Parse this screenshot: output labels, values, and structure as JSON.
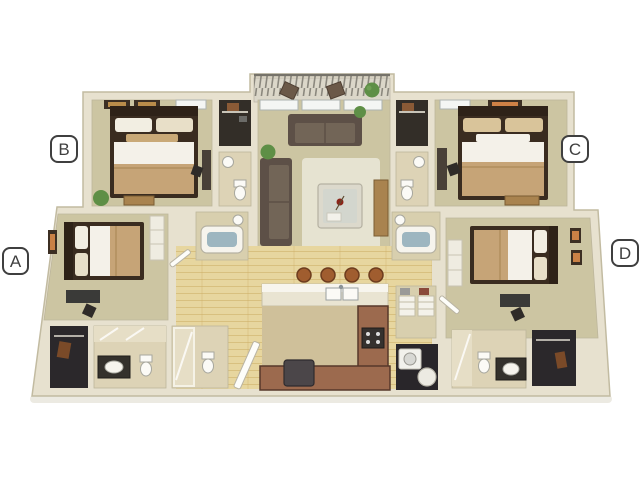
{
  "page": {
    "background_color": "#ffffff"
  },
  "floorplan": {
    "description": "3D rendered top-down floor plan of a four-bedroom, four-bath apartment with central living room, kitchen with breakfast bar, balcony, laundry and closets",
    "labels": {
      "a": "A",
      "b": "B",
      "c": "C",
      "d": "D"
    },
    "colors": {
      "wall_cream": "#e7e1cf",
      "wall_edge": "#c2bba1",
      "bedroom_floor_khaki": "#ccc5a2",
      "bath_floor_tile": "#ddd3b6",
      "wood_floor": "#e7d69f",
      "wood_plank_line": "#caa95f",
      "kitchen_counter_brown": "#9c6a4e",
      "counter_edge_dark": "#57382a",
      "dark_room": "#2b282b",
      "sofa_brown": "#6f6355",
      "bed_blanket_tan": "#c6a477",
      "bed_sheet_white": "#f4f1e9",
      "plant_green": "#5e8f46",
      "bar_stool_rust": "#a05d2f",
      "tub_water_blue": "#9db6c0",
      "label_outline_gray": "#3f3f3f"
    }
  }
}
